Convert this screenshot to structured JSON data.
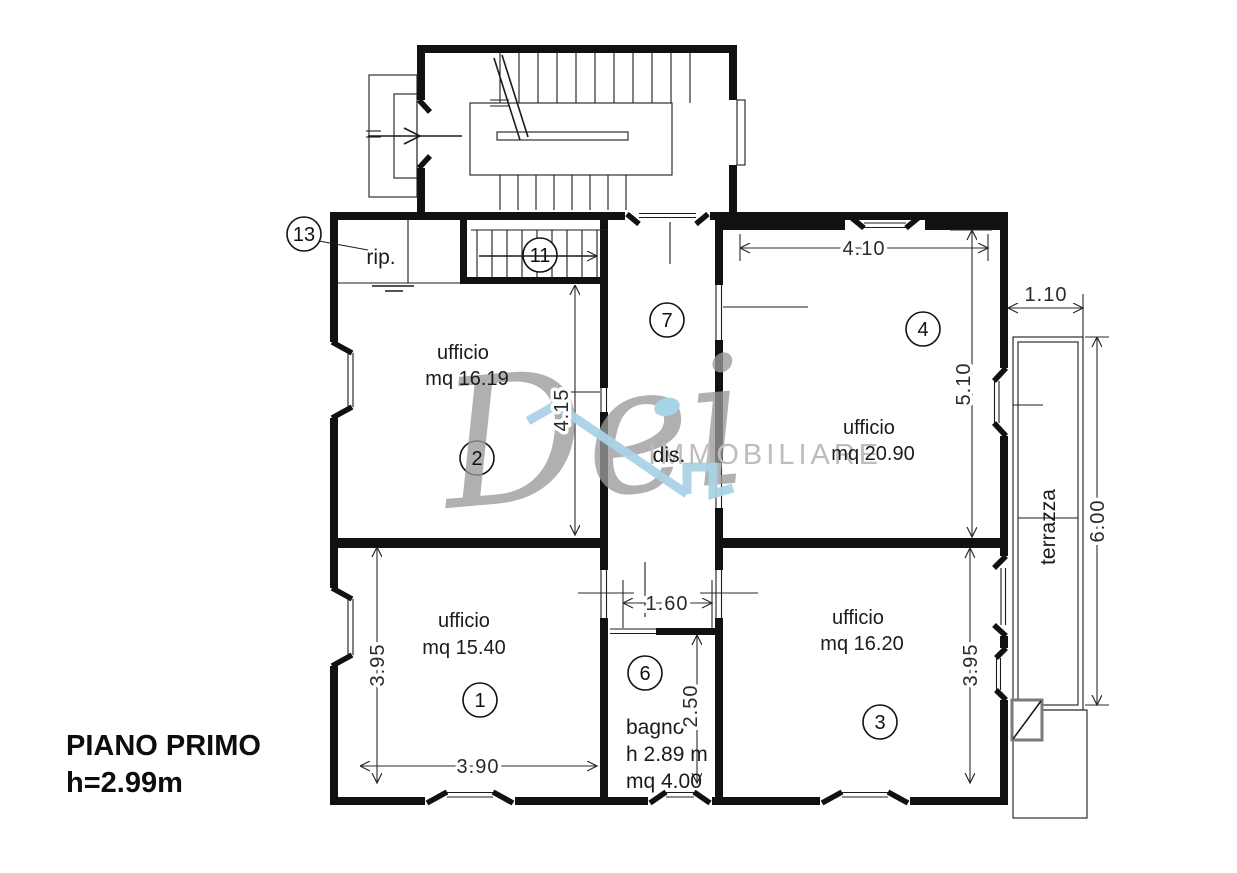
{
  "plan": {
    "title_line1": "PIANO PRIMO",
    "title_line2": "h=2.99m",
    "rooms": {
      "office1": {
        "name": "ufficio",
        "area": "mq 15.40",
        "tag": "1"
      },
      "office2": {
        "name": "ufficio",
        "area": "mq 16.19",
        "tag": "2"
      },
      "office3": {
        "name": "ufficio",
        "area": "mq 16.20",
        "tag": "3"
      },
      "office4": {
        "name": "ufficio",
        "area": "mq 20.90",
        "tag": "4"
      },
      "bathroom": {
        "name": "bagno",
        "ceiling_height": "h 2.89 m",
        "area": "mq 4.00",
        "tag": "6"
      },
      "hallway": {
        "name": "dis.",
        "tag": "7"
      },
      "staircase": {
        "tag": "11"
      },
      "closet": {
        "name": "rip.",
        "tag": "13"
      },
      "terrace": {
        "name": "terrazza"
      }
    },
    "dimensions": {
      "room4_width": "4.10",
      "terrace_width": "1.10",
      "room4_depth": "5.10",
      "terrace_length": "6.00",
      "room2_depth": "4.15",
      "bath_width": "1.60",
      "bath_depth": "2.50",
      "room1_depth": "3.95",
      "room1_width": "3.90",
      "room3_depth": "3.95"
    }
  },
  "watermark": {
    "script": "Dei",
    "caps": "IMMOBILIARE"
  },
  "colors": {
    "line": "#111111",
    "watermark_gray": "#9b9b9b",
    "watermark_light": "#bdbdbd",
    "watermark_blue": "#a9d3e6"
  }
}
